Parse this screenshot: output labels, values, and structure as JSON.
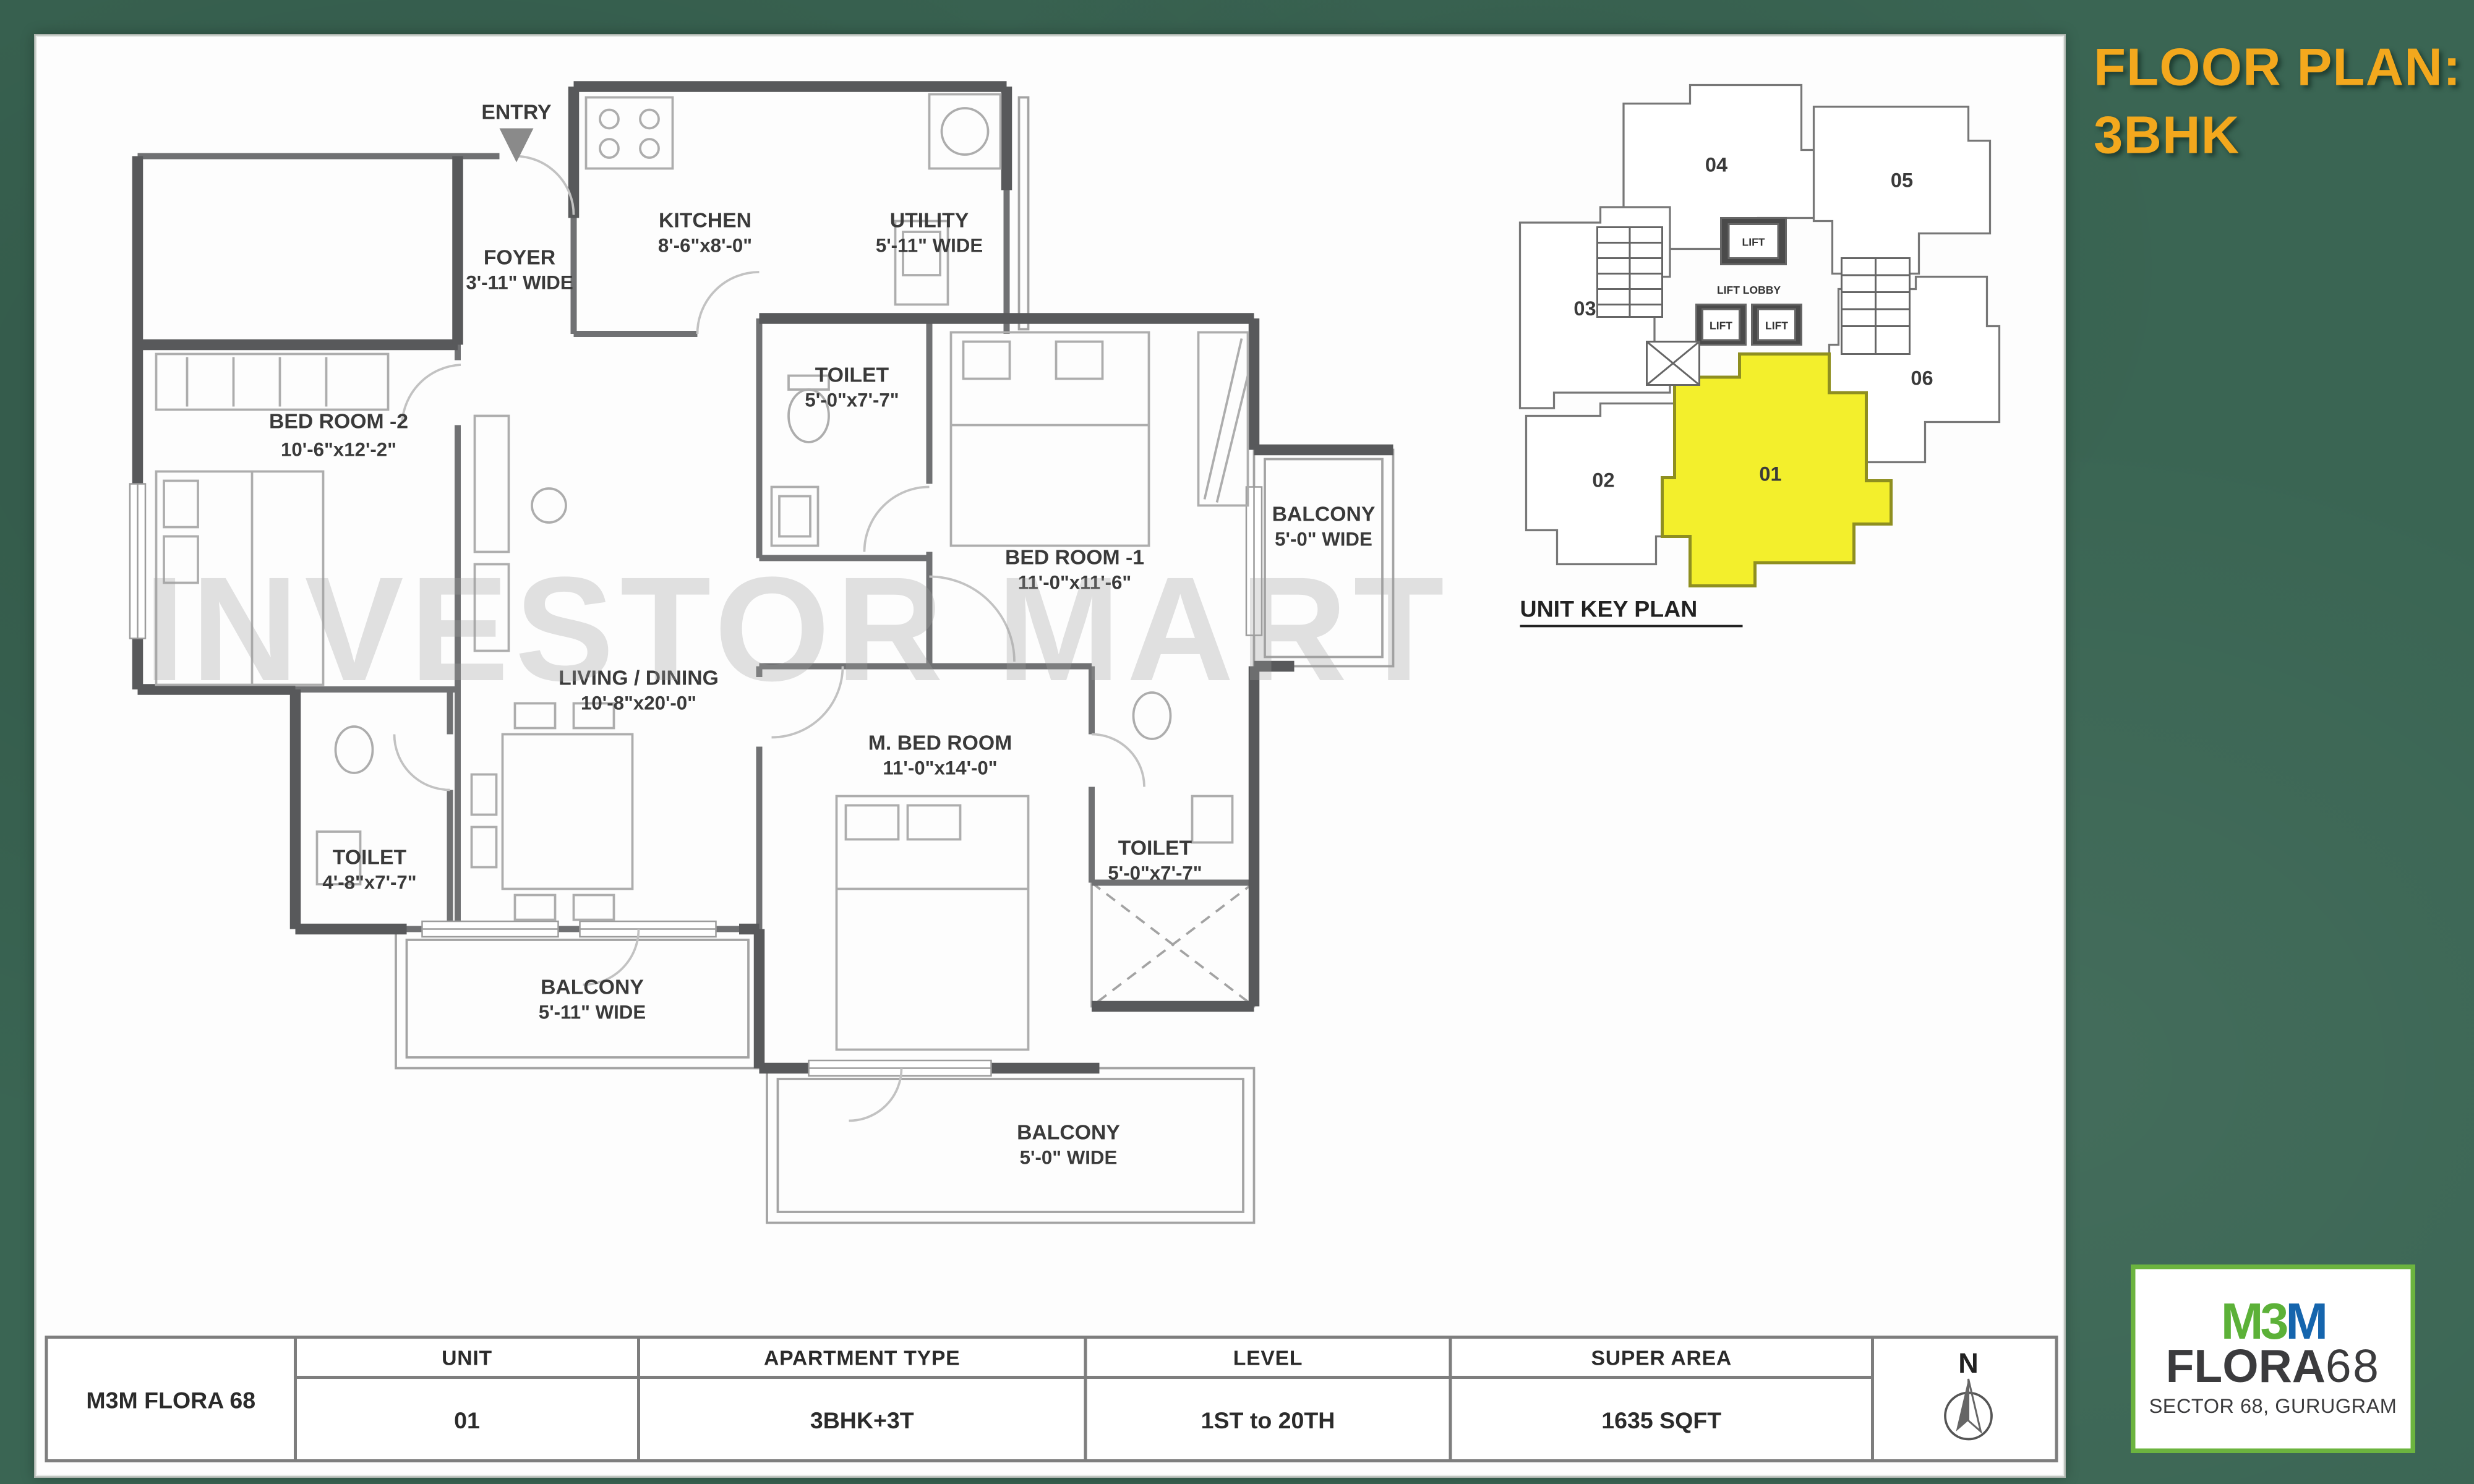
{
  "page": {
    "background": "#3A6553",
    "accent": "#F3A81D",
    "wall_color": "#58595B",
    "highlight_unit_color": "#F3EF2C",
    "logo_green": "#5CB138",
    "logo_blue": "#1565AD"
  },
  "title": {
    "line1": "FLOOR PLAN:",
    "line2": "3BHK"
  },
  "watermark": "INVESTOR MART",
  "plan": {
    "entry": "ENTRY",
    "rooms": {
      "foyer": {
        "name": "FOYER",
        "dim": "3'-11\" WIDE"
      },
      "kitchen": {
        "name": "KITCHEN",
        "dim": "8'-6\"x8'-0\""
      },
      "utility": {
        "name": "UTILITY",
        "dim": "5'-11\" WIDE"
      },
      "toilet_top": {
        "name": "TOILET",
        "dim": "5'-0\"x7'-7\""
      },
      "bedroom2": {
        "name": "BED ROOM -2",
        "dim": "10'-6\"x12'-2\""
      },
      "bedroom1": {
        "name": "BED ROOM -1",
        "dim": "11'-0\"x11'-6\""
      },
      "balcony_right": {
        "name": "BALCONY",
        "dim": "5'-0\" WIDE"
      },
      "living": {
        "name": "LIVING / DINING",
        "dim": "10'-8\"x20'-0\""
      },
      "master": {
        "name": "M. BED ROOM",
        "dim": "11'-0\"x14'-0\""
      },
      "toilet_left": {
        "name": "TOILET",
        "dim": "4'-8\"x7'-7\""
      },
      "toilet_right": {
        "name": "TOILET",
        "dim": "5'-0\"x7'-7\""
      },
      "balcony_bl": {
        "name": "BALCONY",
        "dim": "5'-11\" WIDE"
      },
      "balcony_br": {
        "name": "BALCONY",
        "dim": "5'-0\" WIDE"
      }
    }
  },
  "key_plan": {
    "title": "UNIT KEY PLAN",
    "lift": "LIFT",
    "lift_lobby": "LIFT LOBBY",
    "units": {
      "u01": "01",
      "u02": "02",
      "u03": "03",
      "u04": "04",
      "u05": "05",
      "u06": "06"
    }
  },
  "table": {
    "project": "M3M FLORA 68",
    "north": "N",
    "columns": {
      "unit": {
        "header": "UNIT",
        "value": "01"
      },
      "type": {
        "header": "APARTMENT TYPE",
        "value": "3BHK+3T"
      },
      "level": {
        "header": "LEVEL",
        "value": "1ST to 20TH"
      },
      "area": {
        "header": "SUPER AREA",
        "value": "1635 SQFT"
      }
    }
  },
  "logo": {
    "m1": "M",
    "three": "3",
    "m2": "M",
    "name": "FLORA",
    "number": "68",
    "location": "SECTOR 68, GURUGRAM"
  }
}
